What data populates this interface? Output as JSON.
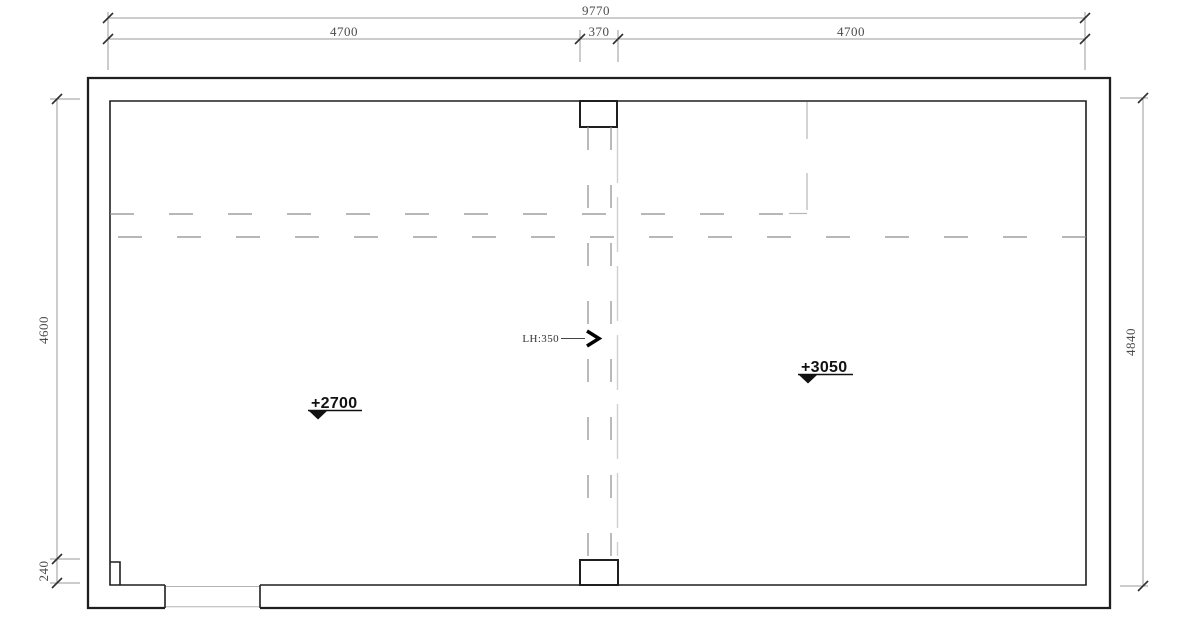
{
  "drawing": {
    "type": "architectural-ceiling-plan",
    "background": "#ffffff",
    "colors": {
      "wall": "#1f1f1f",
      "dashed_beam": "#8c8c8c",
      "dashed_centerline": "#cfcfcf",
      "dashed_boundary": "#b8b8b8",
      "dimension_line": "#9a9a9a",
      "dimension_text": "#4c4c4c",
      "annotation": "#111111"
    },
    "icons": {
      "dim_terminator": "tick-slash",
      "level_marker": "triangle-down",
      "leader_arrow": "chevron-right"
    }
  },
  "dims": {
    "top_total": "9770",
    "top_left": "4700",
    "top_mid": "370",
    "top_right": "4700",
    "left_main": "4600",
    "left_small": "240",
    "right_main": "4840"
  },
  "levels": {
    "left": "+2700",
    "right": "+3050"
  },
  "beam_label": "LH:350"
}
